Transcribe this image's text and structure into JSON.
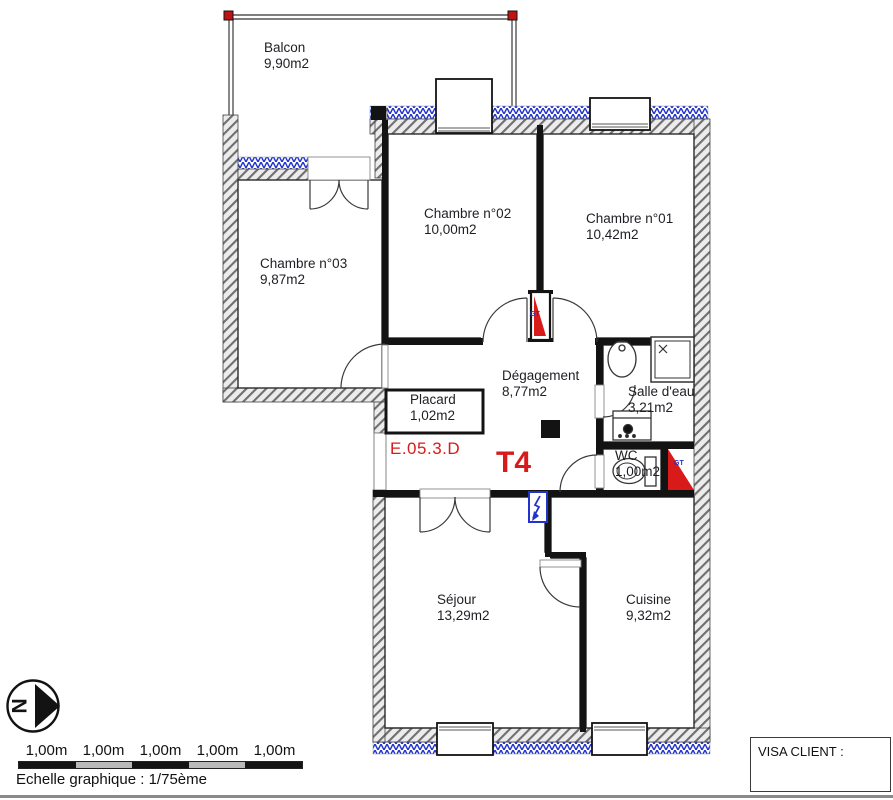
{
  "plan": {
    "rooms": [
      {
        "id": "balcon",
        "name": "Balcon",
        "area": "9,90m2"
      },
      {
        "id": "chambre02",
        "name": "Chambre n°02",
        "area": "10,00m2"
      },
      {
        "id": "chambre01",
        "name": "Chambre n°01",
        "area": "10,42m2"
      },
      {
        "id": "chambre03",
        "name": "Chambre n°03",
        "area": "9,87m2"
      },
      {
        "id": "degagement",
        "name": "Dégagement",
        "area": "8,77m2"
      },
      {
        "id": "placard",
        "name": "Placard",
        "area": "1,02m2"
      },
      {
        "id": "salle_eau",
        "name": "Salle d'eau",
        "area": "3,21m2"
      },
      {
        "id": "wc",
        "name": "WC",
        "area": "1,00m2"
      },
      {
        "id": "sejour",
        "name": "Séjour",
        "area": "13,29m2"
      },
      {
        "id": "cuisine",
        "name": "Cuisine",
        "area": "9,32m2"
      }
    ],
    "unit_code": "E.05.3.D",
    "unit_type": "T4",
    "gt_label": "GT",
    "colors": {
      "highlight_red": "#d81a1a",
      "annotation_blue": "#2233cc",
      "insulation_blue": "#2233cc",
      "wall_black": "#131313",
      "hatch_gray": "#6f6f6f"
    }
  },
  "legend": {
    "north_label": "N",
    "scale_segments": [
      "1,00m",
      "1,00m",
      "1,00m",
      "1,00m",
      "1,00m"
    ],
    "scale_caption": "Echelle graphique : 1/75ème"
  },
  "visa": {
    "label": "VISA CLIENT :"
  }
}
